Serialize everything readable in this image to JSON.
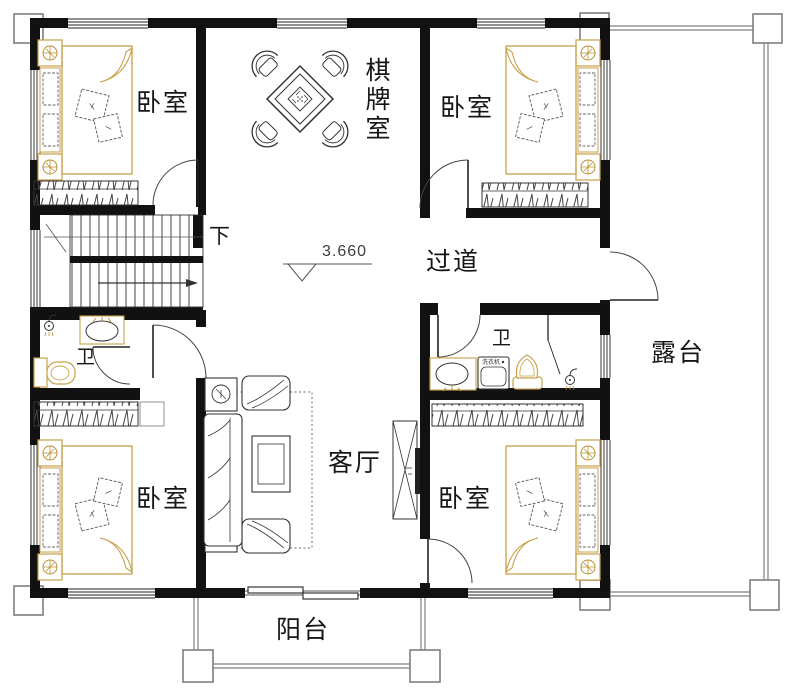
{
  "plan": {
    "type": "residential-floor-plan",
    "labels": {
      "bedroom_tl": "卧室",
      "bedroom_tr": "卧室",
      "bedroom_bl": "卧室",
      "bedroom_br": "卧室",
      "game_room": "棋牌室",
      "corridor": "过道",
      "living_room": "客厅",
      "bathroom_left": "卫",
      "bathroom_right": "卫",
      "balcony": "阳台",
      "terrace": "露台",
      "stairs_down": "下",
      "floor_level": "3.660",
      "washer": "洗衣机"
    },
    "colors": {
      "wall": "#111111",
      "line": "#333333",
      "furniture_accent": "#c9a14a",
      "column_gray": "#7f7f7f",
      "background": "#ffffff"
    }
  }
}
